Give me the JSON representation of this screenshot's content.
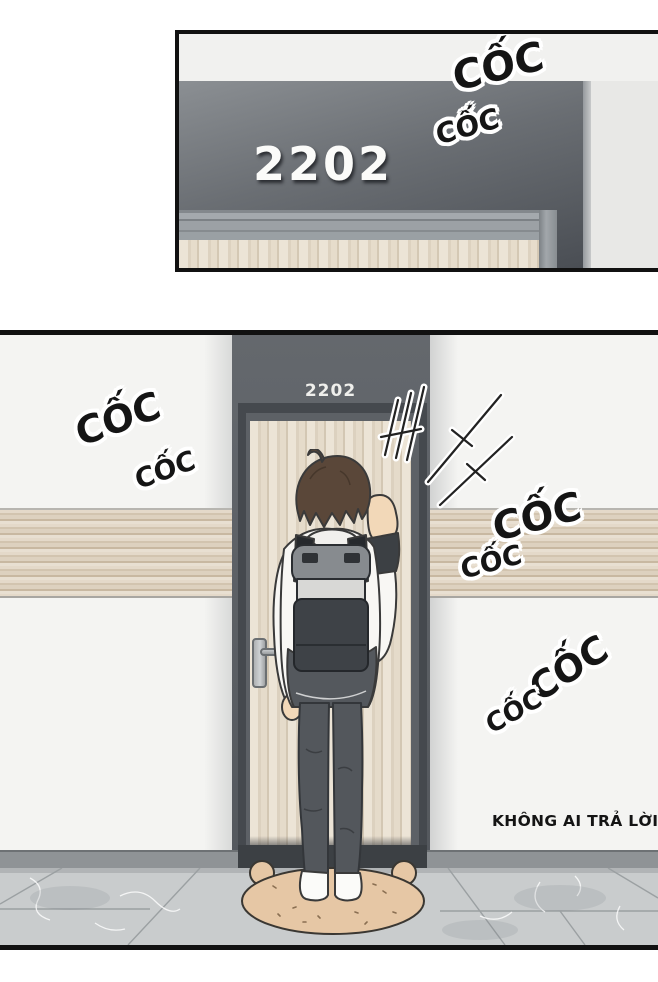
{
  "panel_top": {
    "door_number": "2202",
    "sfx": [
      {
        "text": "CỐC"
      },
      {
        "text": "CỐC"
      }
    ]
  },
  "panel_bottom": {
    "door_number": "2202",
    "sfx": [
      {
        "text": "CỐC"
      },
      {
        "text": "CỐC"
      },
      {
        "text": "CỐC"
      },
      {
        "text": "CỐC"
      },
      {
        "text": "CỐC"
      },
      {
        "text": "CỐC"
      }
    ],
    "caption": "KHÔNG AI TRẢ LỜI"
  },
  "colors": {
    "panel_border": "#111111",
    "dark_wall": "#5d6166",
    "dark_wall_gradient_top_panel": [
      "#8b8f93",
      "#4a4e54"
    ],
    "door_wood": "#e5dbca",
    "wood_band": "#ddd1bf",
    "white_wall": "#f4f4f2",
    "floor_tile": "#c9cccd",
    "baseboard": "#8f9396",
    "doormat": "#e6c7a5",
    "hair": "#5a4739",
    "jacket": "#f8f7f4",
    "backpack_body": "#3e4247",
    "backpack_flap": "#878b8f",
    "pants": "#53575c",
    "skin": "#f2d8b8",
    "sfx_text": "#151515",
    "door_number_text": "#fbfbf9",
    "caption_text": "#141414"
  }
}
